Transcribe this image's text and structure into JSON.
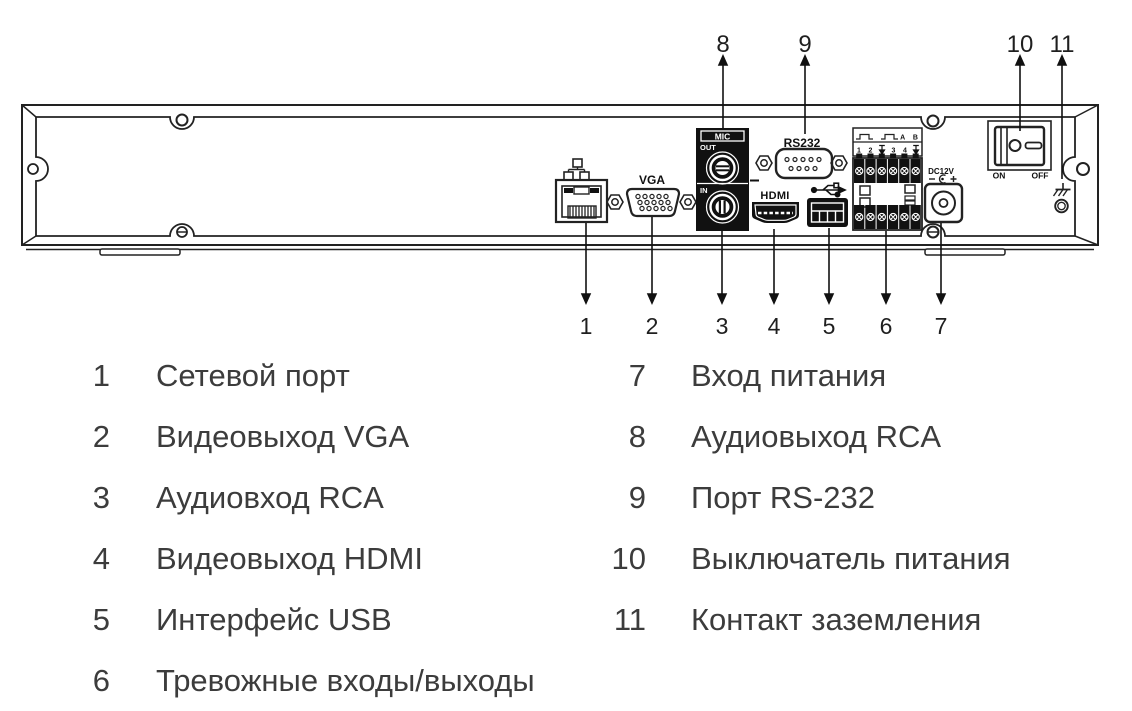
{
  "diagram": {
    "callouts_top": [
      "8",
      "9",
      "10",
      "11"
    ],
    "callouts_bottom": [
      "1",
      "2",
      "3",
      "4",
      "5",
      "6",
      "7"
    ],
    "labels": {
      "mic": "MIC",
      "mic_out": "OUT",
      "mic_in": "IN",
      "vga": "VGA",
      "rs232": "RS232",
      "hdmi": "HDMI",
      "dc": "DC12V",
      "on": "ON",
      "off": "OFF",
      "terminal_ab": "A B",
      "terminal_numbers": [
        "1",
        "2",
        "3",
        "4"
      ]
    },
    "colors": {
      "line": "#222222",
      "port_fill": "#111111"
    }
  },
  "legend": {
    "items": [
      {
        "num": "1",
        "label": "Сетевой порт"
      },
      {
        "num": "2",
        "label": "Видеовыход VGA"
      },
      {
        "num": "3",
        "label": "Аудиовход RCA"
      },
      {
        "num": "4",
        "label": "Видеовыход HDMI"
      },
      {
        "num": "5",
        "label": "Интерфейс USB"
      },
      {
        "num": "6",
        "label": "Тревожные входы/выходы"
      },
      {
        "num": "7",
        "label": "Вход питания"
      },
      {
        "num": "8",
        "label": "Аудиовыход RCA"
      },
      {
        "num": "9",
        "label": "Порт RS-232"
      },
      {
        "num": "10",
        "label": "Выключатель питания"
      },
      {
        "num": "11",
        "label": "Контакт заземления"
      }
    ]
  }
}
